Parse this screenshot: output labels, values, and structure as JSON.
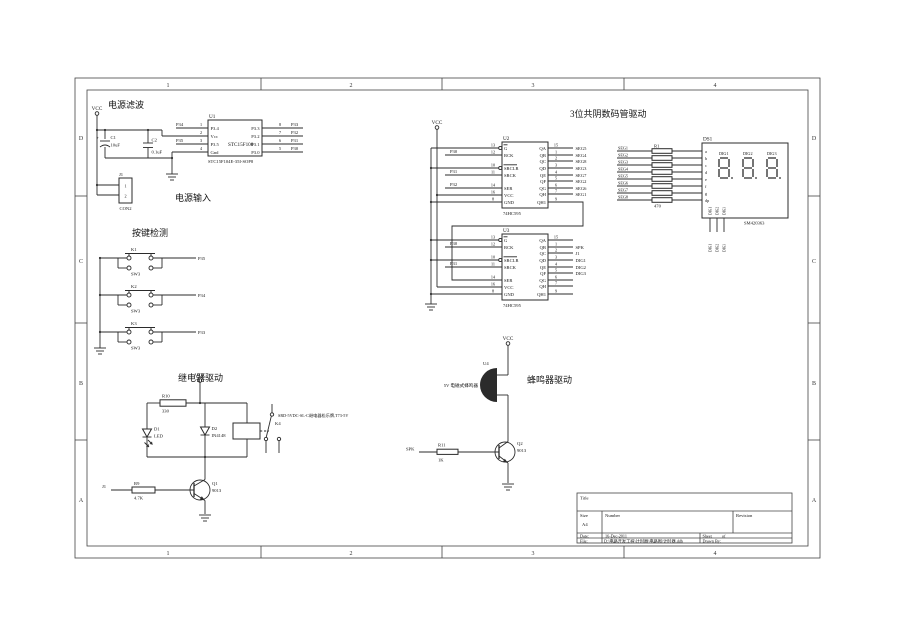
{
  "labels": {
    "vcc": "VCC"
  },
  "frame": {
    "cols": [
      "1",
      "2",
      "3",
      "4"
    ],
    "rows": [
      "D",
      "C",
      "B",
      "A"
    ]
  },
  "power": {
    "title": "电源滤波",
    "input_title": "电源输入",
    "c1_ref": "C1",
    "c1_val": "10uF",
    "c1_pol": "+",
    "c2_ref": "C2",
    "c2_val": "0.1uF",
    "p34": "P34",
    "p35": "P35",
    "u1": {
      "ref": "U1",
      "name": "STC15F100",
      "part": "STC15F104E-35I-SOP8",
      "left": [
        {
          "n": "1",
          "name": "P3.4"
        },
        {
          "n": "2",
          "name": "Vcc"
        },
        {
          "n": "3",
          "name": "P3.5"
        },
        {
          "n": "4",
          "name": "Gnd"
        }
      ],
      "right": [
        {
          "n": "8",
          "name": "P3.3",
          "net": "P33"
        },
        {
          "n": "7",
          "name": "P3.2",
          "net": "P32"
        },
        {
          "n": "6",
          "name": "P3.1",
          "net": "P31"
        },
        {
          "n": "5",
          "name": "P3.0",
          "net": "P30"
        }
      ]
    },
    "j1": {
      "ref": "J1",
      "type": "CON2",
      "p1": "1",
      "p2": "2"
    }
  },
  "keys": {
    "title": "按键检测",
    "sw": [
      {
        "ref": "K1",
        "type": "SW3",
        "net": "P35"
      },
      {
        "ref": "K2",
        "type": "SW3",
        "net": "P34"
      },
      {
        "ref": "K3",
        "type": "SW3",
        "net": "P33"
      }
    ]
  },
  "disp": {
    "title": "3位共阴数码管驱动",
    "u2": {
      "ref": "U2",
      "part": "74HC595",
      "left": [
        {
          "n": "13",
          "name": "G",
          "net": ""
        },
        {
          "n": "12",
          "name": "RCK",
          "net": "P30"
        },
        {
          "n": "10",
          "name": "SRCLR",
          "net": ""
        },
        {
          "n": "11",
          "name": "SRCK",
          "net": "P31"
        },
        {
          "n": "14",
          "name": "SER",
          "net": "P32"
        },
        {
          "n": "16",
          "name": "VCC",
          "net": ""
        },
        {
          "n": "8",
          "name": "GND",
          "net": ""
        }
      ],
      "right": [
        {
          "n": "15",
          "name": "QA",
          "net": "SEG5"
        },
        {
          "n": "1",
          "name": "QB",
          "net": "SEG4"
        },
        {
          "n": "2",
          "name": "QC",
          "net": "SEG8"
        },
        {
          "n": "3",
          "name": "QD",
          "net": "SEG3"
        },
        {
          "n": "4",
          "name": "QE",
          "net": "SEG7"
        },
        {
          "n": "5",
          "name": "QF",
          "net": "SEG2"
        },
        {
          "n": "6",
          "name": "QG",
          "net": "SEG6"
        },
        {
          "n": "7",
          "name": "QH",
          "net": "SEG1"
        },
        {
          "n": "9",
          "name": "QH1",
          "net": ""
        }
      ]
    },
    "u3": {
      "ref": "U3",
      "part": "74HC595",
      "left": [
        {
          "n": "13",
          "name": "G",
          "net": ""
        },
        {
          "n": "12",
          "name": "RCK",
          "net": "P30"
        },
        {
          "n": "10",
          "name": "SRCLR",
          "net": ""
        },
        {
          "n": "11",
          "name": "SRCK",
          "net": "P31"
        },
        {
          "n": "14",
          "name": "SER",
          "net": ""
        },
        {
          "n": "16",
          "name": "VCC",
          "net": ""
        },
        {
          "n": "8",
          "name": "GND",
          "net": ""
        }
      ],
      "right": [
        {
          "n": "15",
          "name": "QA",
          "net": ""
        },
        {
          "n": "1",
          "name": "QB",
          "net": "SPK"
        },
        {
          "n": "2",
          "name": "QC",
          "net": "J1"
        },
        {
          "n": "3",
          "name": "QD",
          "net": "DIG1"
        },
        {
          "n": "4",
          "name": "QE",
          "net": "DIG2"
        },
        {
          "n": "5",
          "name": "QF",
          "net": "DIG3"
        },
        {
          "n": "6",
          "name": "QG",
          "net": ""
        },
        {
          "n": "7",
          "name": "QH",
          "net": ""
        },
        {
          "n": "9",
          "name": "QH1",
          "net": ""
        }
      ]
    },
    "r1": {
      "ref": "R1",
      "val": "470"
    },
    "segs": [
      "SEG1",
      "SEG2",
      "SEG3",
      "SEG4",
      "SEG5",
      "SEG6",
      "SEG7",
      "SEG8"
    ],
    "ds1": {
      "ref": "DS1",
      "part": "SM420363",
      "digits": [
        "DIG1",
        "DIG2",
        "DIG3"
      ],
      "pins": [
        "a",
        "b",
        "c",
        "d",
        "e",
        "f",
        "g",
        "dp"
      ],
      "nets": [
        "DIG1",
        "DIG2",
        "DIG3"
      ]
    }
  },
  "relay": {
    "title": "继电器驱动",
    "in_net": "J1",
    "r10": {
      "ref": "R10",
      "val": "330"
    },
    "r9": {
      "ref": "R9",
      "val": "4.7K"
    },
    "d1": {
      "ref": "D1",
      "val": "LED"
    },
    "d2": {
      "ref": "D2",
      "val": "IN4148"
    },
    "k4": {
      "ref": "K4",
      "note": "SRD-5VDC-SL-C继电器松乐牌,T73-5V"
    },
    "q1": {
      "ref": "Q1",
      "val": "9013"
    }
  },
  "buzz": {
    "title": "蜂鸣器驱动",
    "in_net": "SPK",
    "u4": {
      "ref": "U4",
      "note": "5V 电磁式蜂鸣器"
    },
    "q2": {
      "ref": "Q2",
      "val": "9013"
    },
    "r11": {
      "ref": "R11",
      "val": "1K"
    }
  },
  "tb": {
    "title_label": "Title",
    "size_label": "Size",
    "size": "A4",
    "number_label": "Number",
    "rev_label": "Revision",
    "date_label": "Date:",
    "date": "16-Dec-2011",
    "sheet_label": "Sheet",
    "of_label": "of",
    "file_label": "File:",
    "file": "D:\\电路开发工程\\计时器\\电路图\\计时器.ddb",
    "drawn_label": "Drawn By:"
  }
}
